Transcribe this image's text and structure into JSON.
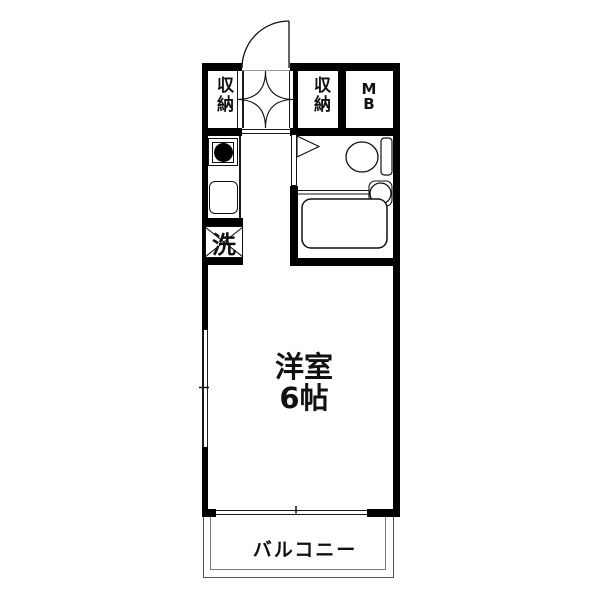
{
  "floorplan": {
    "labels": {
      "closet_left": "収納",
      "closet_right": "収納",
      "meter_box_line1": "M",
      "meter_box_line2": "B",
      "washing_machine": "洗",
      "room_name": "洋室",
      "room_size": "6帖",
      "balcony": "バルコニー"
    },
    "colors": {
      "wall": "#000000",
      "line": "#1a1a1a",
      "background": "#ffffff",
      "text": "#111111"
    }
  }
}
